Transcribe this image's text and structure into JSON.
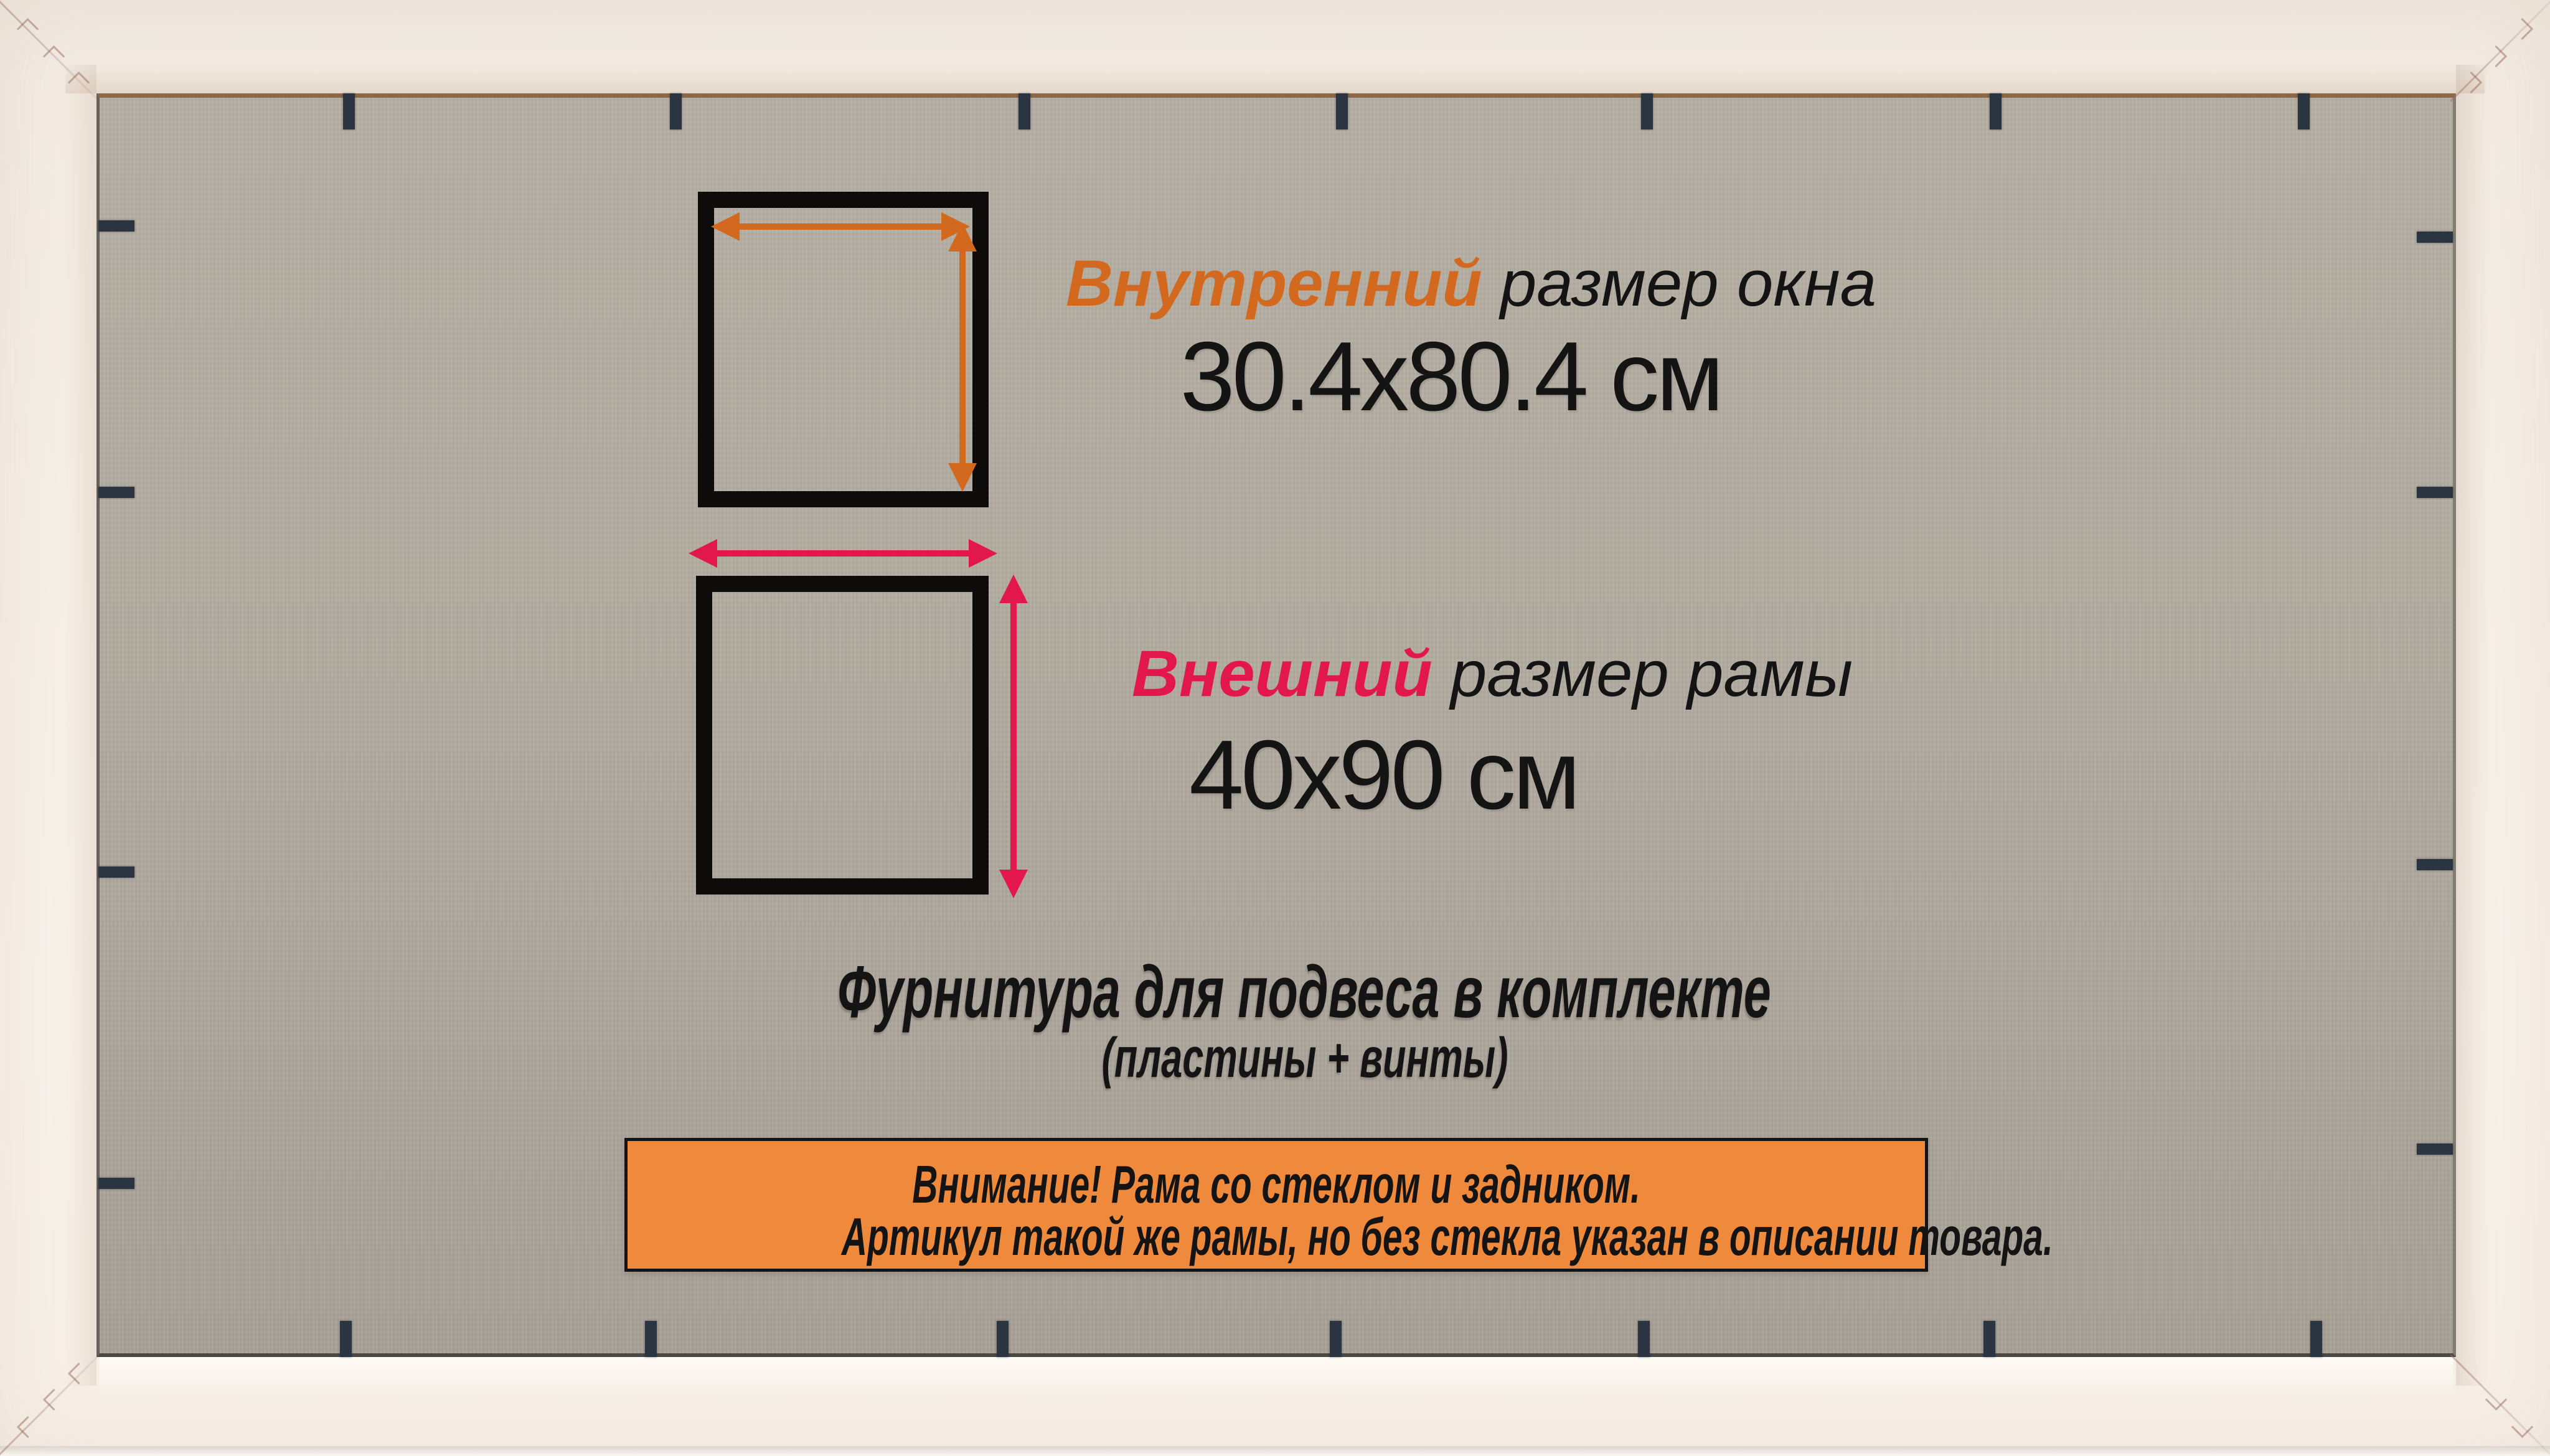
{
  "diagram": {
    "inner_size": {
      "accent": "Внутренний",
      "rest": "размер окна",
      "value": "30.4x80.4 см"
    },
    "outer_size": {
      "accent": "Внешний",
      "rest": "размер рамы",
      "value": "40x90 см"
    }
  },
  "notes": {
    "hardware_line1": "Фурнитура для подвеса в комплекте",
    "hardware_line2": "(пластины + винты)"
  },
  "warning_banner": {
    "line1": "Внимание! Рама со стеклом и задником.",
    "line2": "Артикул такой же рамы, но без стекла указан в описании товара."
  },
  "icons": {
    "inner_width_arrow": "double-headed-horizontal-arrow",
    "inner_height_arrow": "double-headed-vertical-arrow",
    "outer_width_arrow": "double-headed-horizontal-arrow",
    "outer_height_arrow": "double-headed-vertical-arrow"
  },
  "colors": {
    "accent_inner": "#d2691e",
    "accent_outer": "#e2174e",
    "text": "#141414",
    "banner_bg": "#ef8a3c",
    "banner_border": "#141414",
    "square_border": "#0d0c0a",
    "frame_white": "#f6efe7",
    "backing": "#b2aba0",
    "tab": "#2b3542"
  }
}
